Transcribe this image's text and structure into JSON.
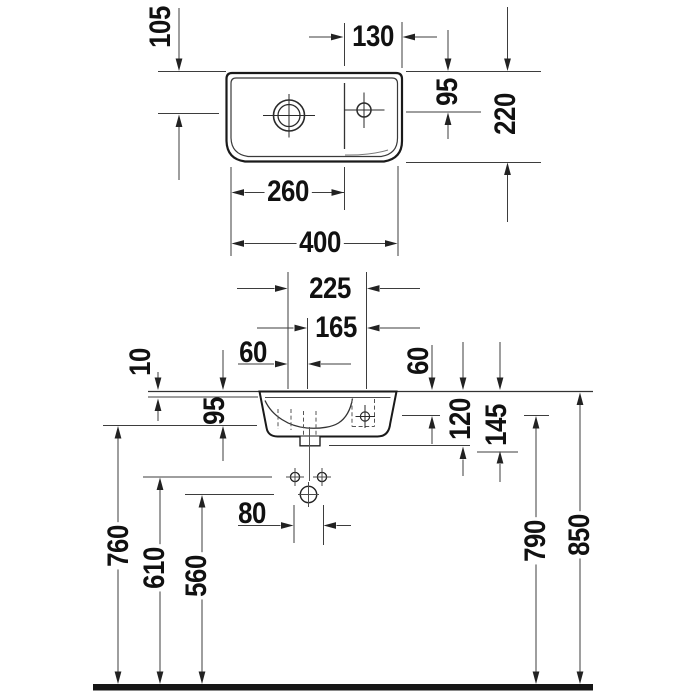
{
  "dims": {
    "top_drain_setback": "105",
    "top_tap_zone_width": "130",
    "top_tap_setback": "95",
    "top_depth": "220",
    "top_basin_width": "260",
    "top_overall_width": "400",
    "front_tap_center": "225",
    "front_drain_to_tap": "165",
    "front_basin_offset": "60",
    "front_rim_step": "10",
    "front_body_height": "95",
    "front_fixing_drop": "60",
    "front_drop_120": "120",
    "front_drop_145": "145",
    "front_fixing_span": "80",
    "front_height_760": "760",
    "front_height_610": "610",
    "front_height_560": "560",
    "front_height_790": "790",
    "front_height_850": "850"
  }
}
